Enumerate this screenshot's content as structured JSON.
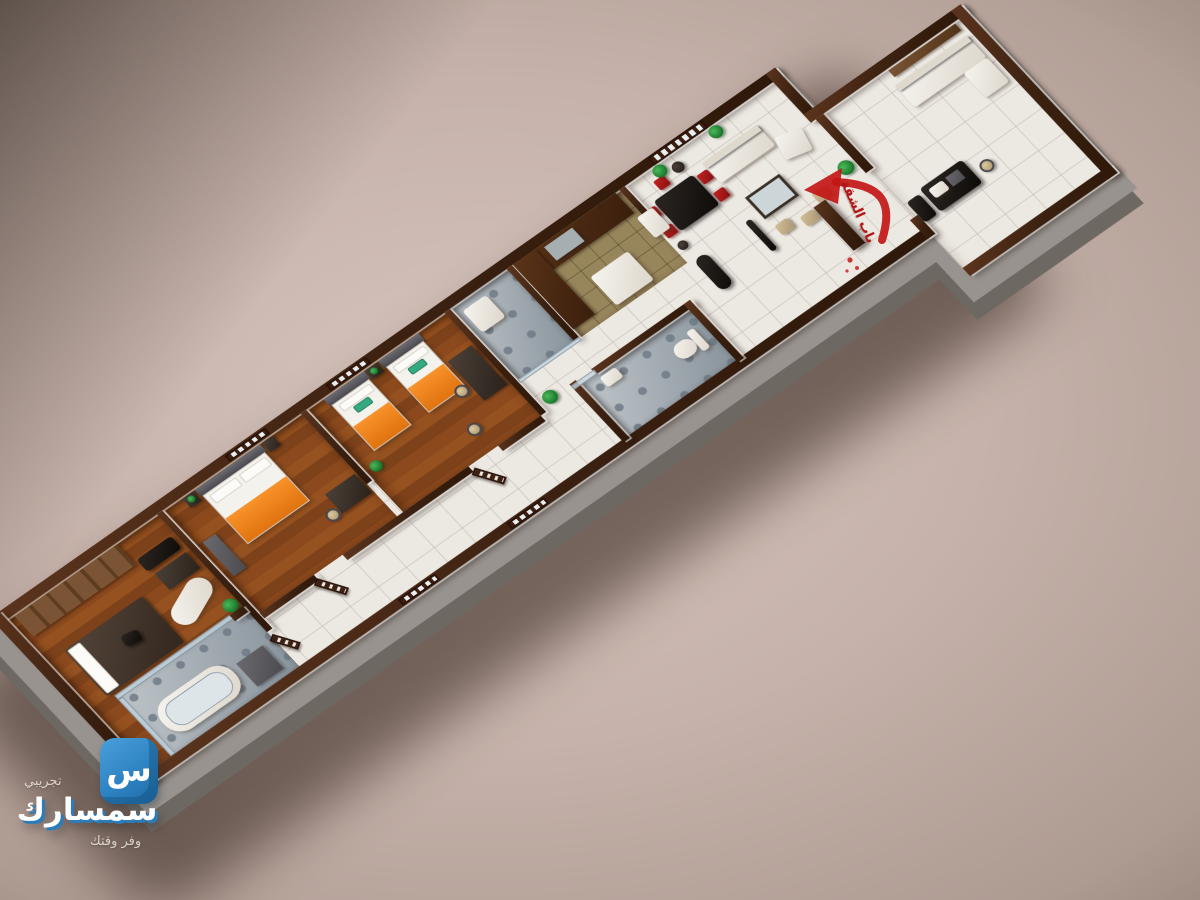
{
  "watermark": {
    "badge_letter": "س",
    "label_top": "تجريبي",
    "brand": "سمسارك",
    "tagline": "وفر وقتك"
  },
  "annotation": {
    "label": "باب الشقة"
  },
  "palette": {
    "brand_blue": "#2e83c2",
    "annotation_red": "#c31616",
    "bedding_orange": "#f5831e",
    "pillow_teal_green": "#35a982",
    "wall_top_brown": "#3a2010",
    "wood_floor_brown": "#8a4a1f",
    "floor_tile_white": "#ece8e2",
    "kitchen_tile_tan": "#97855c",
    "bathroom_gray": "#a9b2b8",
    "sofa_white": "#f6f4ef",
    "dining_chair_red": "#c42222",
    "plinth_gray": "#98938e",
    "backdrop_taupe": "#c6b2aa"
  }
}
